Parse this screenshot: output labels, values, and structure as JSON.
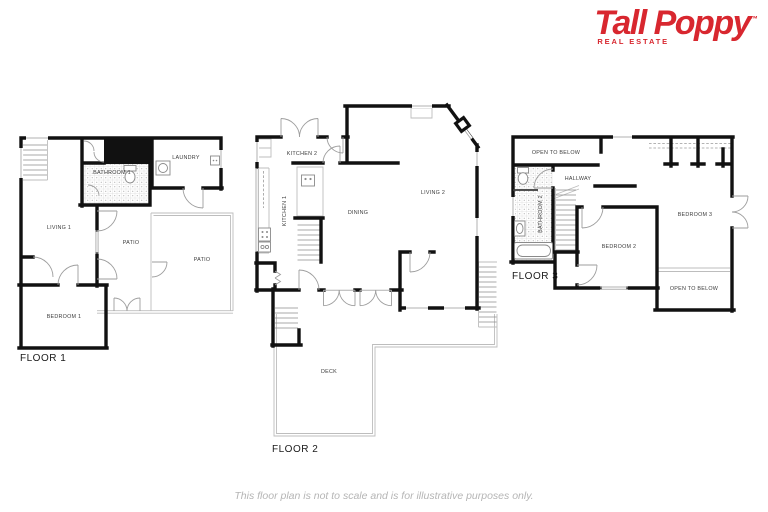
{
  "brand": {
    "name": "Tall Poppy",
    "trademark": "™",
    "tagline": "REAL ESTATE",
    "color": "#d8272f"
  },
  "disclaimer": "This floor plan is not to scale and is for illustrative purposes only.",
  "floor1": {
    "label": "FLOOR 1",
    "living": "LIVING 1",
    "bathroom": "BATHROOM 1",
    "laundry": "LAUNDRY",
    "patio_small": "PATIO",
    "patio_large": "PATIO",
    "bedroom": "BEDROOM 1"
  },
  "floor2": {
    "label": "FLOOR 2",
    "kitchen2": "KITCHEN 2",
    "kitchen1": "KITCHEN 1",
    "dining": "DINING",
    "living": "LIVING 2",
    "deck": "DECK"
  },
  "floor3": {
    "label": "FLOOR 3",
    "open_below_top": "OPEN TO BELOW",
    "hallway": "HALLWAY",
    "bathroom": "BATHROOM 2",
    "bedroom2": "BEDROOM 2",
    "bedroom3": "BEDROOM 3",
    "open_below_bottom": "OPEN TO BELOW"
  },
  "colors": {
    "wall": "#111111",
    "fixture": "#8a8a8a",
    "disclaimer_gray": "#b5b5b5"
  }
}
